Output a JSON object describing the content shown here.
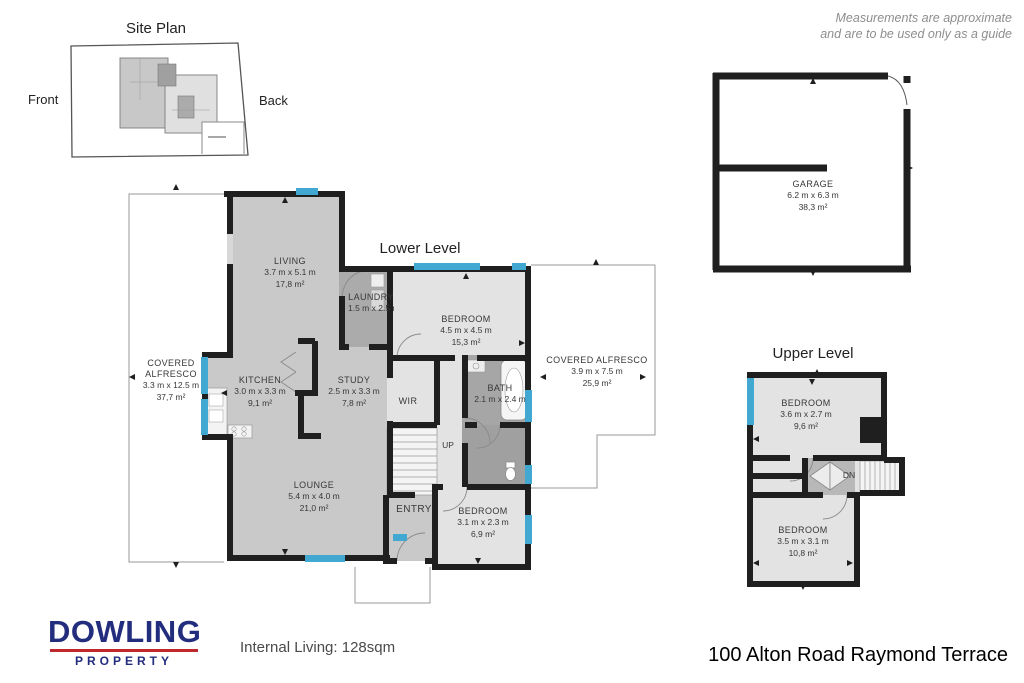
{
  "disclaimer": {
    "line1": "Measurements are approximate",
    "line2": "and are to be used only as a guide"
  },
  "site_plan": {
    "title": "Site Plan",
    "front_label": "Front",
    "back_label": "Back"
  },
  "levels": {
    "lower": "Lower Level",
    "upper": "Upper Level"
  },
  "rooms": {
    "garage": {
      "name": "GARAGE",
      "dims": "6.2 m x 6.3 m",
      "area": "38,3 m²"
    },
    "living": {
      "name": "LIVING",
      "dims": "3.7 m x 5.1 m",
      "area": "17,8 m²"
    },
    "laundry": {
      "name": "LAUNDRY",
      "dims": "1.5 m x 2.5 m"
    },
    "bedroom1": {
      "name": "BEDROOM",
      "dims": "4.5 m x 4.5 m",
      "area": "15,3 m²"
    },
    "alfresco_left": {
      "name": "COVERED ALFRESCO",
      "dims": "3.3 m x 12.5 m",
      "area": "37,7 m²"
    },
    "kitchen": {
      "name": "KITCHEN",
      "dims": "3.0 m x 3.3 m",
      "area": "9,1 m²"
    },
    "study": {
      "name": "STUDY",
      "dims": "2.5 m x 3.3 m",
      "area": "7,8 m²"
    },
    "wir": {
      "name": "WIR"
    },
    "bath": {
      "name": "BATH",
      "dims": "2.1 m x 2.4 m"
    },
    "alfresco_right": {
      "name": "COVERED ALFRESCO",
      "dims": "3.9 m x 7.5 m",
      "area": "25,9 m²"
    },
    "lounge": {
      "name": "LOUNGE",
      "dims": "5.4 m x 4.0 m",
      "area": "21,0 m²"
    },
    "entry": {
      "name": "ENTRY"
    },
    "bedroom2": {
      "name": "BEDROOM",
      "dims": "3.1 m x 2.3 m",
      "area": "6,9 m²"
    },
    "stairs_up": "UP",
    "bedroom3": {
      "name": "BEDROOM",
      "dims": "3.6 m x 2.7 m",
      "area": "9,6 m²"
    },
    "stairs_dn": "DN",
    "bedroom4": {
      "name": "BEDROOM",
      "dims": "3.5 m x 3.1 m",
      "area": "10,8 m²"
    }
  },
  "logo": {
    "brand": "DOWLING",
    "subtitle": "PROPERTY"
  },
  "footer": {
    "internal_living": "Internal Living: 128sqm",
    "address": "100 Alton Road Raymond Terrace"
  },
  "colors": {
    "wall": "#1f1f1f",
    "window": "#41a9d1",
    "floor_mid": "#c9c9c9",
    "floor_light": "#e3e3e3",
    "floor_dark": "#a6a6a6",
    "logo_navy": "#232d7e",
    "logo_red": "#c0282e"
  }
}
